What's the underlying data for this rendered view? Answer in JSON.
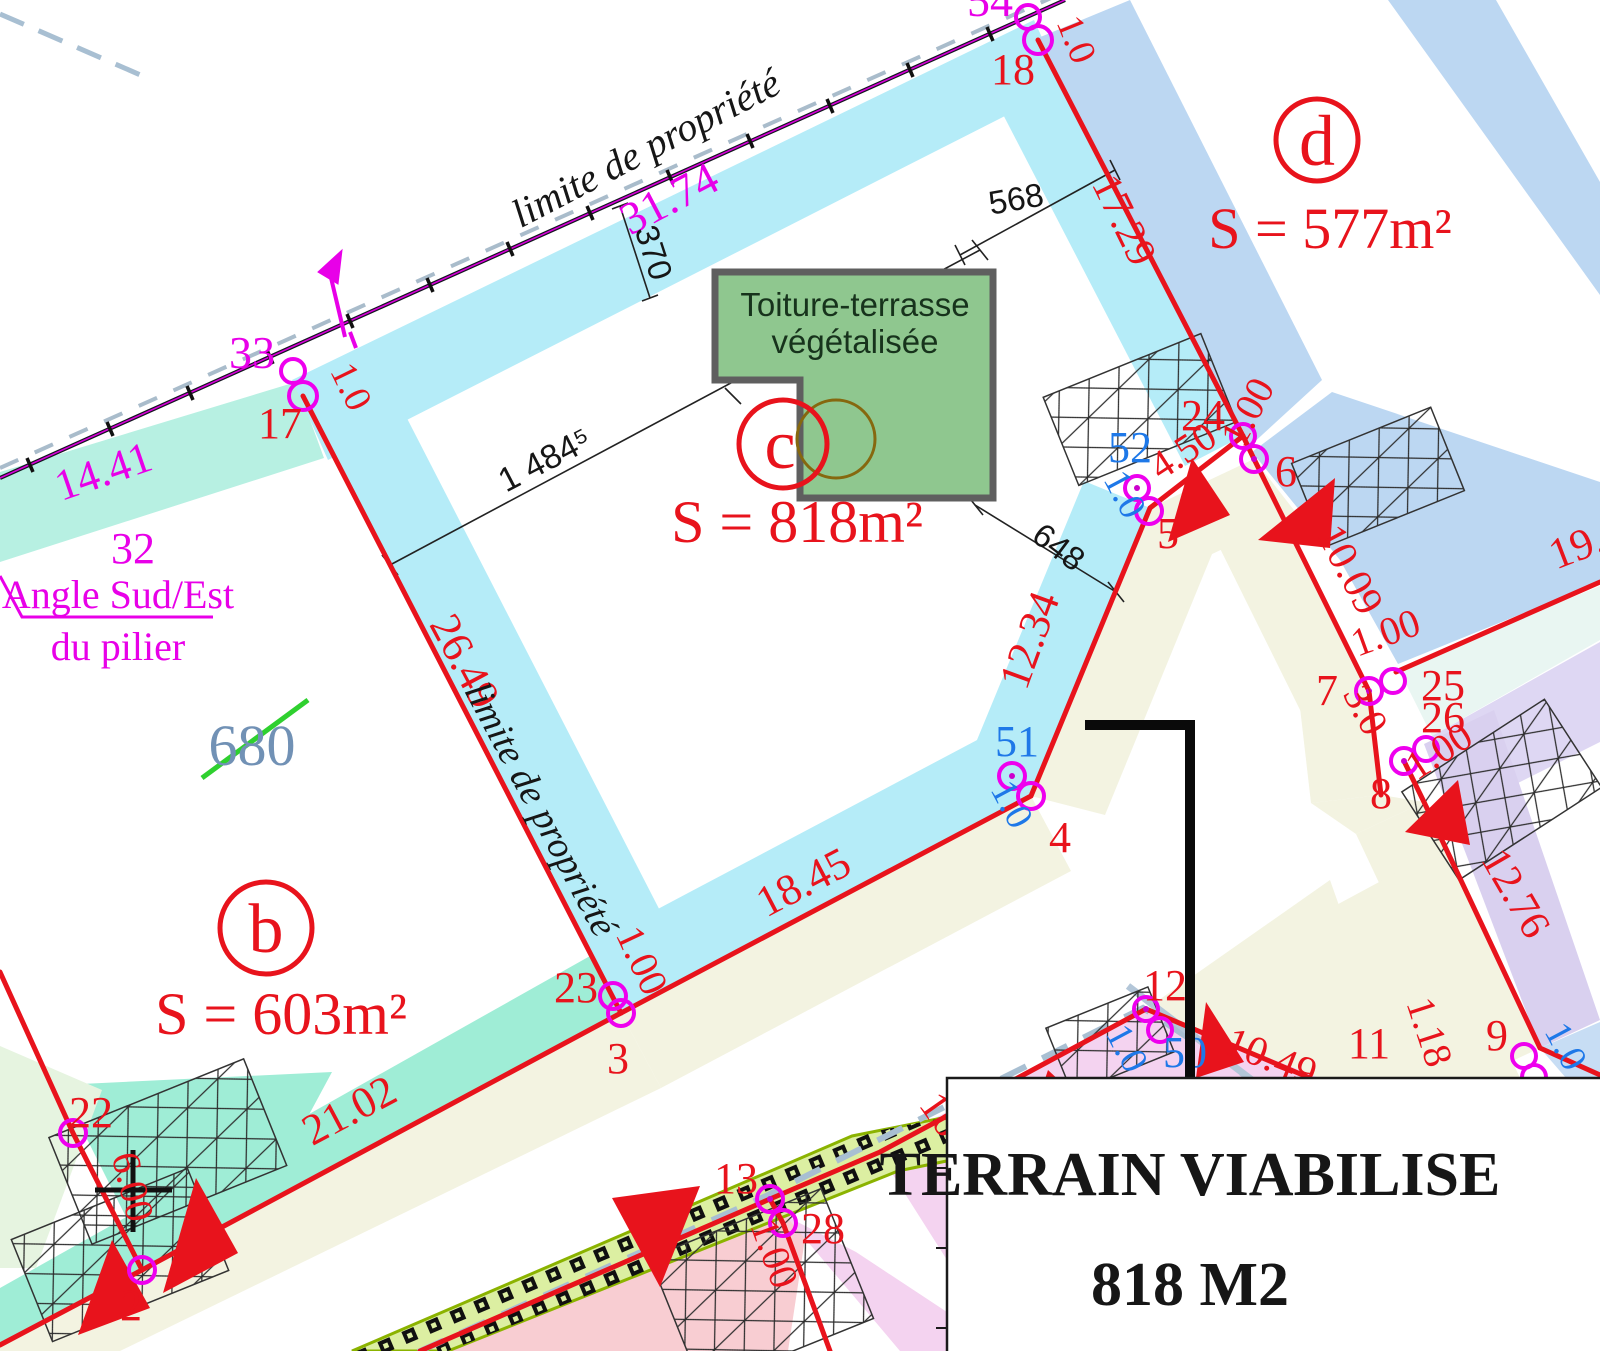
{
  "plan": {
    "boundary_label_top": "limite de propriété",
    "boundary_label_side": "limite de propriété",
    "pillar_note_line1": "Angle Sud/Est",
    "pillar_note_line2": "du pilier",
    "old_parcel_number": "680",
    "building_label_line1": "Toiture-terrasse",
    "building_label_line2": "végétalisée"
  },
  "parcels": {
    "b": {
      "letter": "b",
      "area": "S = 603m²"
    },
    "c": {
      "letter": "c",
      "area": "S = 818m²"
    },
    "d": {
      "letter": "d",
      "area": "S = 577m²"
    }
  },
  "title_box": {
    "line1": "TERRAIN VIABILISE",
    "line2": "818 M2"
  },
  "points": {
    "p2": "2",
    "p3": "3",
    "p4": "4",
    "p5": "5",
    "p6": "6",
    "p7": "7",
    "p8": "8",
    "p9": "9",
    "p11": "11",
    "p12": "12",
    "p13": "13",
    "p17": "17",
    "p18": "18",
    "p22": "22",
    "p23": "23",
    "p24": "24",
    "p25": "25",
    "p26": "26",
    "p28": "28",
    "p32": "32",
    "p33": "33",
    "p50": "50",
    "p51": "51",
    "p52": "52",
    "p54": "54"
  },
  "dimensions": {
    "d31_74": "31.74",
    "d14_41": "14.41",
    "d17_29": "17.29",
    "d26_49": "26.49",
    "d12_34": "12.34",
    "d18_45": "18.45",
    "d21_02": "21.02",
    "d6_00": "6.00",
    "d4_50": "4.50",
    "d10_09": "10.09",
    "d3_0": "3.0",
    "d12_76": "12.76",
    "d19_9": "19.9",
    "d10_49": "10.49",
    "d1_18": "1.18",
    "d16": "16",
    "d370": "370",
    "d568": "568",
    "d648": "648",
    "d1484": "1 484⁵"
  },
  "offsets": {
    "o1_0_18": "1.0",
    "o1_0_17": "1.0",
    "o1_00_23": "1.00",
    "o1_00_24": "1.00",
    "o1_00_25": "1.00",
    "o1_00_26": "1.00",
    "o1_00_28": "1.00",
    "o1_0_51": "1.0",
    "o1_0_52": "1.0",
    "o1_0_50": "1.0",
    "o1_0_9": "1.0"
  },
  "colors": {
    "red": "#e8131c",
    "magenta": "#e800e8",
    "blue_point": "#1e78e8",
    "cyan_band": "#b5ecf8",
    "mint_band": "#b7f0e2",
    "teal_band": "#9fedd6",
    "periwinkle_band": "#bcd7f2",
    "cream_band": "#f3f3e1",
    "pink_band": "#f8cdd2",
    "violet_pink_band": "#f4d3f0",
    "lavender_band": "#d9d0ef",
    "roof_green": "#8fc78f",
    "hatch_green": "#dcefa2",
    "old_number_blue": "#7191b5"
  }
}
